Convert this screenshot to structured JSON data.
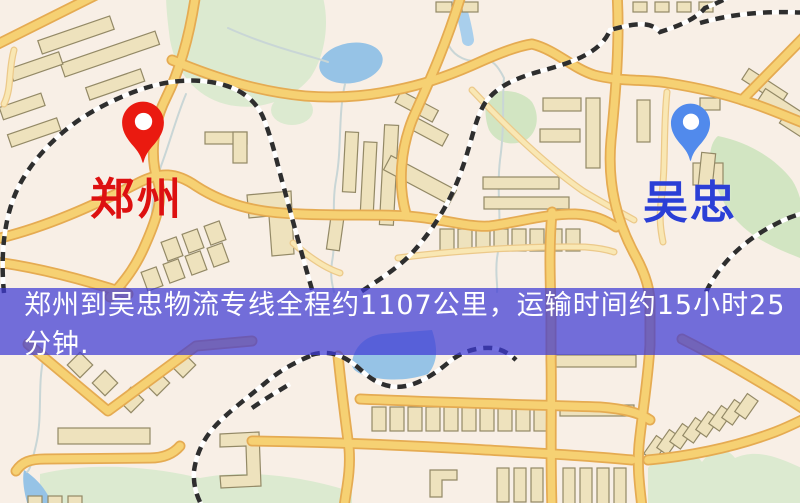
{
  "map": {
    "origin": {
      "name": "郑州",
      "marker_color": "#ea1a10",
      "label_color": "#dd1111"
    },
    "destination": {
      "name": "吴忠",
      "marker_color": "#518aec",
      "label_color": "#2b3fd6"
    },
    "banner": {
      "text": "郑州到吴忠物流专线全程约1107公里，运输时间约15小时25分钟.",
      "text_color": "#ffffff",
      "overlay_color": "rgba(62,58,212,0.72)"
    },
    "palette": {
      "map-bg": "#f8efe6",
      "park": "#dcead0",
      "park-deep": "#d2e5c2",
      "water": "#96c3e6",
      "water-light": "#a9cfec",
      "road-casing": "#e5ab52",
      "road-fill": "#f6d173",
      "road-minor-casing": "#ecc98a",
      "road-minor-fill": "#f9e7b3",
      "building": "#eee2bd",
      "building-line": "#938966",
      "railway-dark": "#2e2e2e",
      "railway-light": "#ffffff",
      "stream": "#c9d6d6"
    }
  }
}
